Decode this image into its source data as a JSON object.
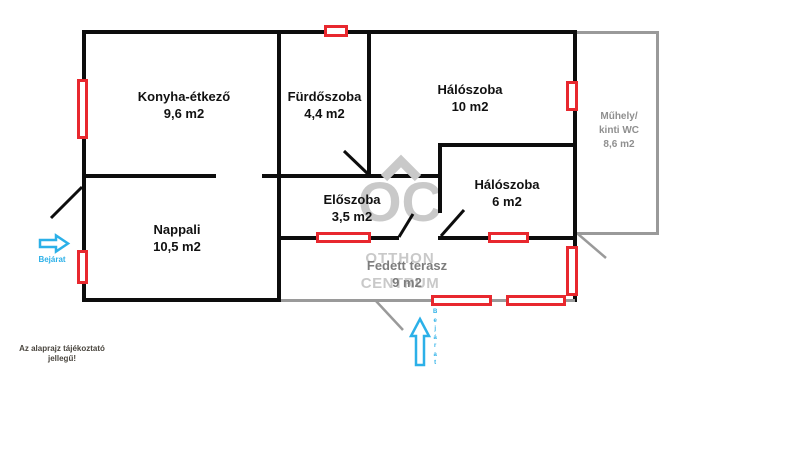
{
  "rooms": {
    "konyha": {
      "name": "Konyha-étkező",
      "area": "9,6 m2"
    },
    "furdoszoba": {
      "name": "Fürdőszoba",
      "area": "4,4 m2"
    },
    "haloszoba_nagy": {
      "name": "Hálószoba",
      "area": "10 m2"
    },
    "haloszoba_kis": {
      "name": "Hálószoba",
      "area": "6 m2"
    },
    "eloszoba": {
      "name": "Előszoba",
      "area": "3,5 m2"
    },
    "nappali": {
      "name": "Nappali",
      "area": "10,5 m2"
    },
    "muhely": {
      "line1": "Műhely/",
      "line2": "kinti WC",
      "area": "8,6 m2"
    },
    "terasz": {
      "name": "Fedett terasz",
      "area": "9 m2"
    }
  },
  "entrances": {
    "left_label": "Bejárat",
    "bottom_label": "Bejárat"
  },
  "watermark": {
    "monogram": "OC",
    "word1": "OTTHON",
    "word2": "CENTRUM"
  },
  "disclaimer": {
    "line1": "Az alaprajz tájékoztató",
    "line2": "jellegű!"
  },
  "colors": {
    "wall_black": "#0d0d0d",
    "window_red": "#e8282e",
    "entrance_blue": "#2bb0e8",
    "secondary_gray": "#9a9a9a",
    "watermark_gray": "#c9c9c9"
  }
}
